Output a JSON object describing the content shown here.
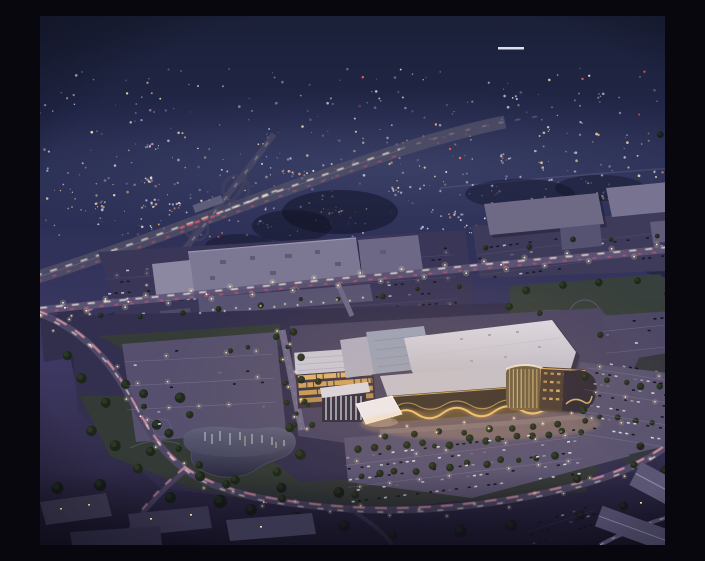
{
  "image": {
    "kind": "aerial-night-rendering",
    "subject": "dusk aerial rendering of a proposed casino entertainment district with golden lit facade, office building, parking fields, pond and ring road, beside an existing shopping mall, highway interchange and suburban city lights stretching to the horizon",
    "width_px": 705,
    "height_px": 529
  },
  "palette": {
    "sky_top": "#1b2038",
    "sky_upper": "#232849",
    "sky_horizon": "#2f3258",
    "dusk_purple": "#3c3760",
    "ground_violet": "#332e4e",
    "foreground": "#221f36",
    "city_cool": "#c9d2ff",
    "city_warm": "#ffe2ad",
    "city_white": "#fff6e8",
    "city_orange": "#ffb070",
    "city_blue": "#9fb0ff",
    "city_red": "#ff6a5e",
    "roof_white": "#dad7e1",
    "roof_gray": "#7c7792",
    "roof_slate": "#9aa1b8",
    "gold": "#f2c572",
    "window_amber": "#e8b96a",
    "trail_pink": "#f0a0b2",
    "trail_red": "#e0556a",
    "trail_white": "#fff3de",
    "street_warm": "#ffe9b4",
    "pole_white": "#fff6d8",
    "asphalt": "#56506e",
    "asphalt_dim": "#3a3658",
    "grass": "#343c33",
    "tree": "#1c2618",
    "tree_lit": "#2e3d26",
    "pond_top": "#5f5f78",
    "pond_bottom": "#2c2b40",
    "blue_canopy": "#2f7bd0",
    "car_dark": "#11101c",
    "car_white": "#d8dae4"
  },
  "procedural": {
    "seed": 20240,
    "city_lights": {
      "count": 540,
      "band_top": 52,
      "band_bottom": 222,
      "clusters": 14
    },
    "road_vehicle_pairs": 16,
    "car_colors": [
      "#11101c",
      "#d8dae4",
      "#9a98a8",
      "#6e6b80",
      "#c2c4d0"
    ],
    "car_color_weights": [
      0.42,
      0.22,
      0.14,
      0.12,
      0.1
    ],
    "lots": [
      {
        "name": "mall-lot",
        "layer": "g-cars-under",
        "x": 66,
        "y": 240,
        "w": 350,
        "h": 62,
        "rot": -4,
        "cx": 240,
        "cy": 270,
        "row_gap": 11,
        "car_gap": 6.5,
        "density": 0.42,
        "dim": true,
        "poles": true,
        "pole_op": 0.45
      },
      {
        "name": "bigbox-lot",
        "layer": "g-cars-under",
        "x": 436,
        "y": 214,
        "w": 248,
        "h": 40,
        "rot": -7,
        "cx": 560,
        "cy": 234,
        "row_gap": 10,
        "car_gap": 6.5,
        "density": 0.36,
        "dim": true,
        "poles": false
      },
      {
        "name": "west-lot",
        "layer": "g-cars",
        "x": 86,
        "y": 330,
        "w": 148,
        "h": 84,
        "rot": -3,
        "cx": 160,
        "cy": 372,
        "row_gap": 12,
        "car_gap": 7,
        "density": 0.06,
        "dim": false,
        "poles": true
      },
      {
        "name": "south-lot",
        "layer": "g-cars",
        "x": 306,
        "y": 424,
        "w": 236,
        "h": 50,
        "rot": -7,
        "cx": 424,
        "cy": 449,
        "row_gap": 11,
        "car_gap": 6.5,
        "density": 0.5,
        "dim": false,
        "poles": true
      },
      {
        "name": "east-lot",
        "layer": "g-cars",
        "x": 542,
        "y": 350,
        "w": 122,
        "h": 82,
        "rot": 9,
        "cx": 603,
        "cy": 391,
        "row_gap": 11,
        "car_gap": 6.5,
        "density": 0.5,
        "dim": false,
        "poles": true
      },
      {
        "name": "ne-lot",
        "layer": "g-cars",
        "x": 564,
        "y": 300,
        "w": 84,
        "h": 36,
        "rot": -6,
        "cx": 606,
        "cy": 318,
        "row_gap": 11,
        "car_gap": 7,
        "density": 0.3,
        "dim": false,
        "poles": false
      },
      {
        "name": "fg-lot",
        "layer": "g-cars",
        "x": 486,
        "y": 496,
        "w": 72,
        "h": 26,
        "rot": -18,
        "cx": 522,
        "cy": 509,
        "row_gap": 9,
        "car_gap": 6,
        "density": 0.5,
        "dim": true,
        "poles": false
      }
    ]
  },
  "regions": [
    {
      "label": "night-sky"
    },
    {
      "label": "distant-city-lights"
    },
    {
      "label": "highway-interchange"
    },
    {
      "label": "retail-mall-area"
    },
    {
      "label": "big-box-stores"
    },
    {
      "label": "arterial-road"
    },
    {
      "label": "casino-development-site"
    },
    {
      "label": "pond"
    },
    {
      "label": "ring-road"
    },
    {
      "label": "residential-foreground"
    }
  ]
}
